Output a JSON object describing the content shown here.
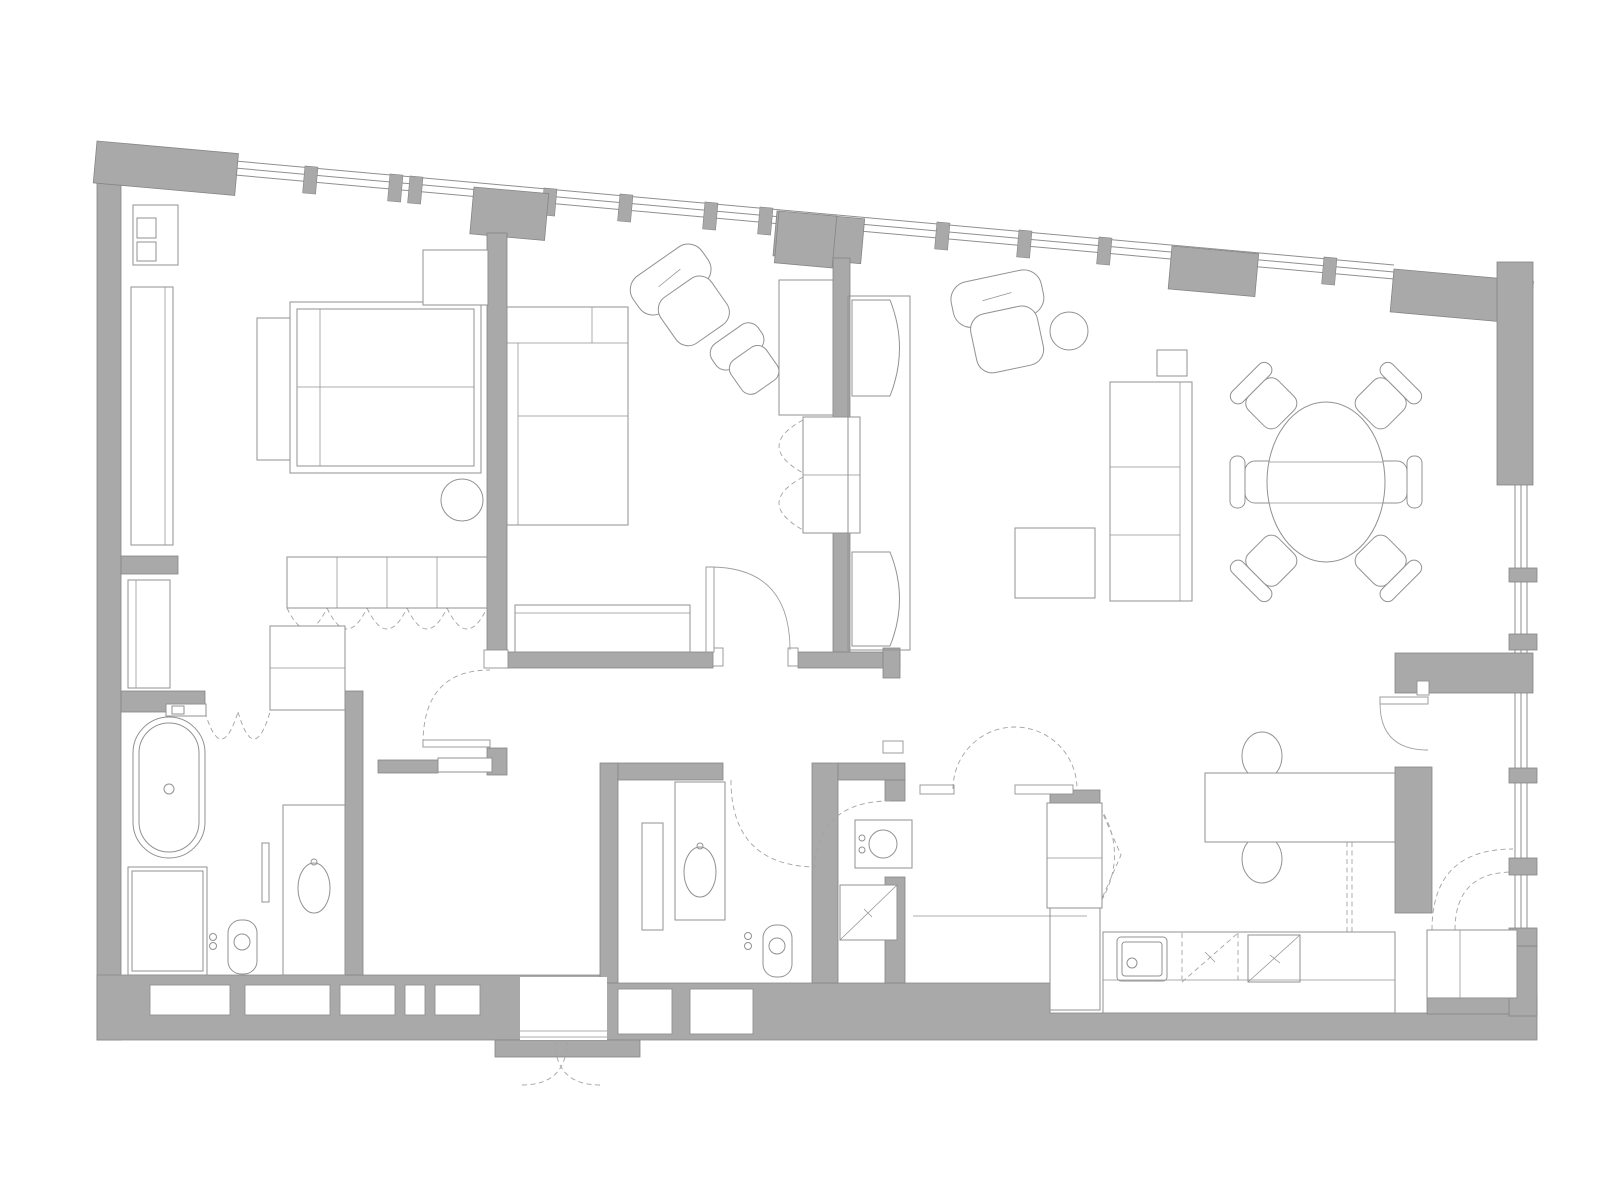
{
  "canvas": {
    "width": 1600,
    "height": 1200
  },
  "drawing_type": "apartment-floor-plan",
  "palette": {
    "background": "#ffffff",
    "wall_fill": "#a9a9a9",
    "wall_edge": "#858585",
    "furniture_line": "#929292",
    "door_arc": "#a0a0a0",
    "dashed_line": "#a3a3a3",
    "glazing_line": "#8f8f8f"
  },
  "rooms": [
    {
      "name": "bedroom",
      "items": [
        "bed",
        "headboard",
        "nightstand-bench",
        "bedside-stool-icon",
        "shelf-unit-icon",
        "tall-cabinet-icon",
        "low-cabinet-icon",
        "sideboard-with-folding-doors"
      ]
    },
    {
      "name": "sitting-room",
      "items": [
        "corner-sofa",
        "armchair-large-icon",
        "armchair-small-icon",
        "tv-cabinet",
        "bench",
        "built-in-wardrobe-folding-doors"
      ]
    },
    {
      "name": "living-room",
      "items": [
        "armchair-icon",
        "round-side-table-icon",
        "sofa",
        "square-side-table-icon",
        "coffee-table",
        "bow-front-cabinet-upper",
        "bow-front-cabinet-lower"
      ]
    },
    {
      "name": "dining-area",
      "items": [
        "oval-dining-table",
        "dining-chair-icon"
      ],
      "dining_chair_count": 6
    },
    {
      "name": "kitchen",
      "items": [
        "work-table",
        "lens-chair-icon",
        "tall-fridge-cabinet-folding-door",
        "base-cabinet",
        "counter",
        "sink-icon",
        "dishwasher-dashed-icon",
        "cooktop-icon",
        "double-swing-door"
      ]
    },
    {
      "name": "bathroom-1",
      "items": [
        "freestanding-bathtub",
        "tub-deck-faucet-icon",
        "shower-enclosure",
        "toilet-icon",
        "flush-dots-icon",
        "vanity-with-oval-sink",
        "mirror-strip",
        "storage-closet",
        "bifold-door-dashed"
      ]
    },
    {
      "name": "bathroom-2",
      "items": [
        "vanity-with-oval-sink",
        "tall-cabinet",
        "toilet-icon",
        "flush-dots-icon",
        "door-swing-dashed"
      ]
    },
    {
      "name": "bathroom-3",
      "items": [
        "round-washbasin-icon",
        "shower-tray-diagonal-icon",
        "door-swing-dashed"
      ]
    },
    {
      "name": "hallway",
      "items": [
        "console-shelf",
        "door-swing-solid",
        "door-swing-dashed"
      ]
    },
    {
      "name": "loggia",
      "items": [
        "appliance-cabinet",
        "door-leaf-with-arc",
        "dashed-swing-arcs"
      ]
    },
    {
      "name": "entry",
      "items": [
        "double-out-swing-door-dashed",
        "threshold-lines",
        "wall-niches"
      ]
    }
  ],
  "window_mullion_count": 12,
  "right_wall_sill_block_count": 5,
  "bottom_wall_niche_count": 7
}
